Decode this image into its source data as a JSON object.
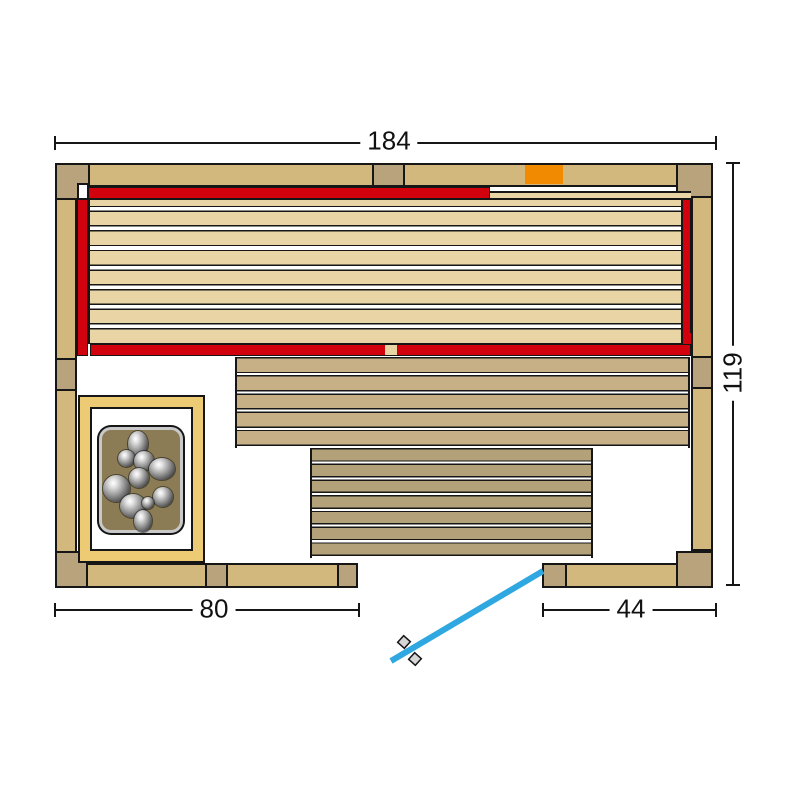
{
  "diagram": {
    "title": "sauna-floor-plan-top-view",
    "dimensions": {
      "overall_width": "184",
      "overall_depth": "119",
      "wall_left_of_door": "80",
      "door_side_segment": "44"
    },
    "colors": {
      "wall": "#d2b87c",
      "wall_dark": "#b9a37d",
      "bench_upper": "#e8d4a4",
      "bench_mid": "#c7b085",
      "bench_low": "#b3a17a",
      "heater_frame": "#eccb74",
      "stone_bed": "#8b7c55",
      "stone_gray": "#9a9a9a",
      "ir_red": "#d2010e",
      "control_orange": "#f18a00",
      "door_blue": "#2fa7e0",
      "outline": "#161616"
    }
  }
}
